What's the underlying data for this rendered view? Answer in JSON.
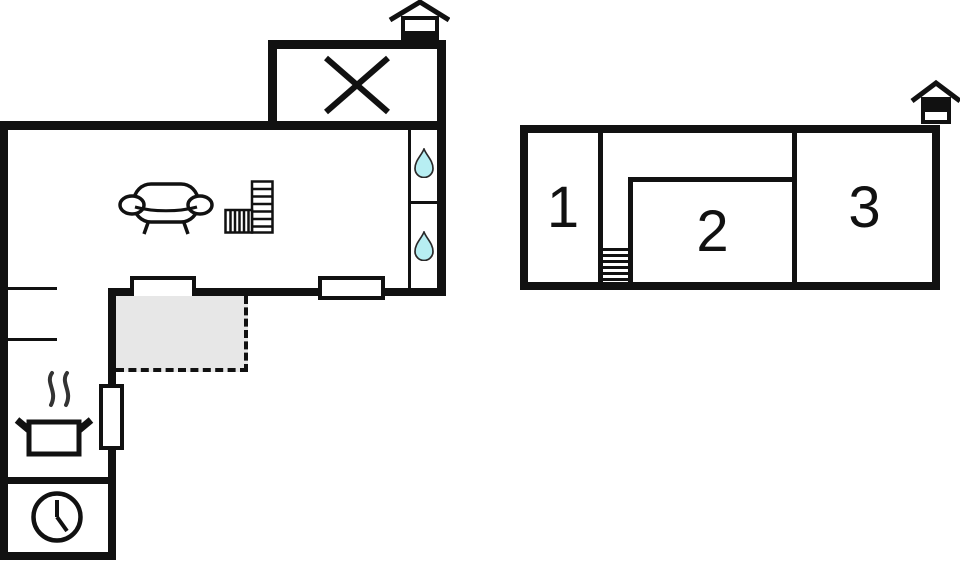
{
  "title": "Holiday house floor plan",
  "colors": {
    "wall": "#111111",
    "background": "#ffffff",
    "terrace_fill": "#e7e7e7",
    "water_drop_fill": "#b7eef2",
    "steam": "#333333"
  },
  "ground_floor": {
    "icons": {
      "entrance": "entrance-house-icon",
      "crossed_area": "x-mark-icon",
      "bath_top": "water-drop-icon",
      "bath_bottom": "water-drop-icon",
      "sofa": "sofa-icon",
      "stairs": "l-shaped-stairs-icon",
      "stove": "cooking-pot-steam-icon",
      "clock": "clock-icon"
    }
  },
  "upper_floor": {
    "rooms": [
      {
        "label": "1"
      },
      {
        "label": "2"
      },
      {
        "label": "3"
      }
    ],
    "icons": {
      "entrance": "entrance-house-icon",
      "stairs": "stairs-icon"
    }
  }
}
